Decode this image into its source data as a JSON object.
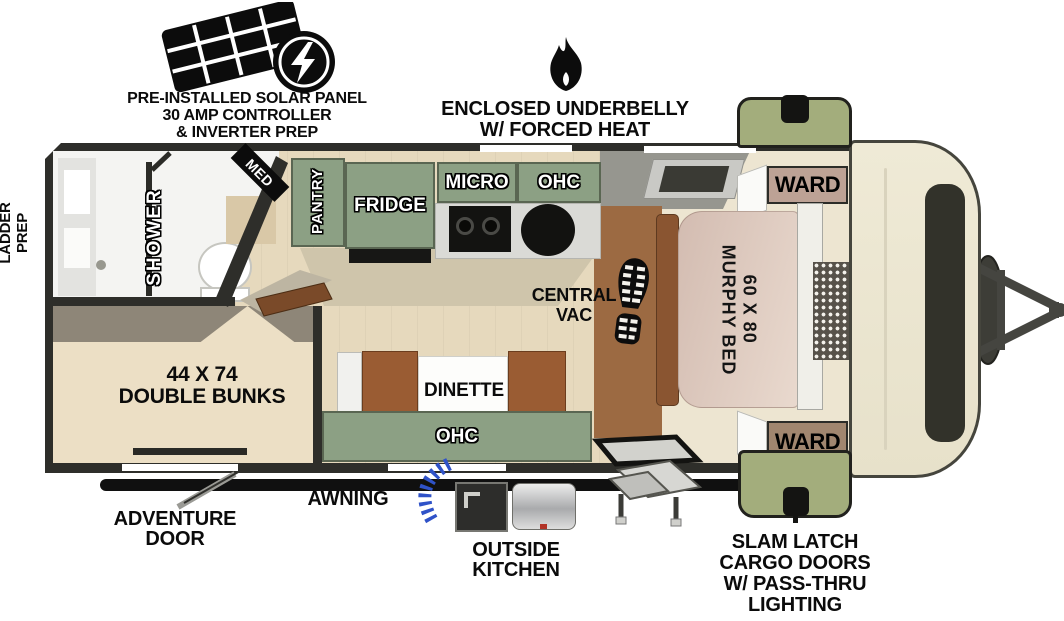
{
  "colors": {
    "cabinet_green": "#8ca084",
    "cargo_door_green": "#a3ad7c",
    "wall_dark": "#2e2e2a",
    "floor_wood": "#e6d9bd",
    "bunk_cream": "#ecdfc5",
    "murphy_bed_pink": "#dcc6bb",
    "ward_top_tan": "#bda295",
    "ward_bottom_brown": "#a1866f",
    "seat_brown": "#9a5c33",
    "hose_blue": "#2f52c8",
    "front_cap_cream": "#efead6"
  },
  "callouts": {
    "solar": {
      "icon": "solar-panel-icon",
      "lines": [
        "PRE-INSTALLED SOLAR PANEL",
        "30 AMP CONTROLLER",
        "& INVERTER PREP"
      ]
    },
    "underbelly": {
      "icon": "flame-icon",
      "lines": [
        "ENCLOSED UNDERBELLY",
        "W/ FORCED HEAT"
      ]
    },
    "ladder_prep": {
      "lines": [
        "LADDER",
        "PREP"
      ]
    },
    "adventure_door": {
      "lines": [
        "ADVENTURE",
        "DOOR"
      ]
    },
    "awning": {
      "label": "AWNING"
    },
    "outside_kitchen": {
      "lines": [
        "OUTSIDE",
        "KITCHEN"
      ]
    },
    "cargo_doors": {
      "lines": [
        "SLAM LATCH",
        "CARGO DOORS",
        "W/ PASS-THRU",
        "LIGHTING"
      ]
    }
  },
  "plan": {
    "shower": "SHOWER",
    "med": "MED",
    "pantry": "PANTRY",
    "fridge": "FRIDGE",
    "micro": "MICRO",
    "ohc_kitchen": "OHC",
    "ward_top": "WARD",
    "ward_bottom": "WARD",
    "murphy_bed": {
      "size": "60 X 80",
      "name": "MURPHY BED"
    },
    "central_vac": {
      "icon": "boot-print-icon",
      "lines": [
        "CENTRAL",
        "VAC"
      ]
    },
    "dinette": "DINETTE",
    "ohc_dinette": "OHC",
    "bunks": {
      "lines": [
        "44 X 74",
        "DOUBLE BUNKS"
      ]
    }
  }
}
